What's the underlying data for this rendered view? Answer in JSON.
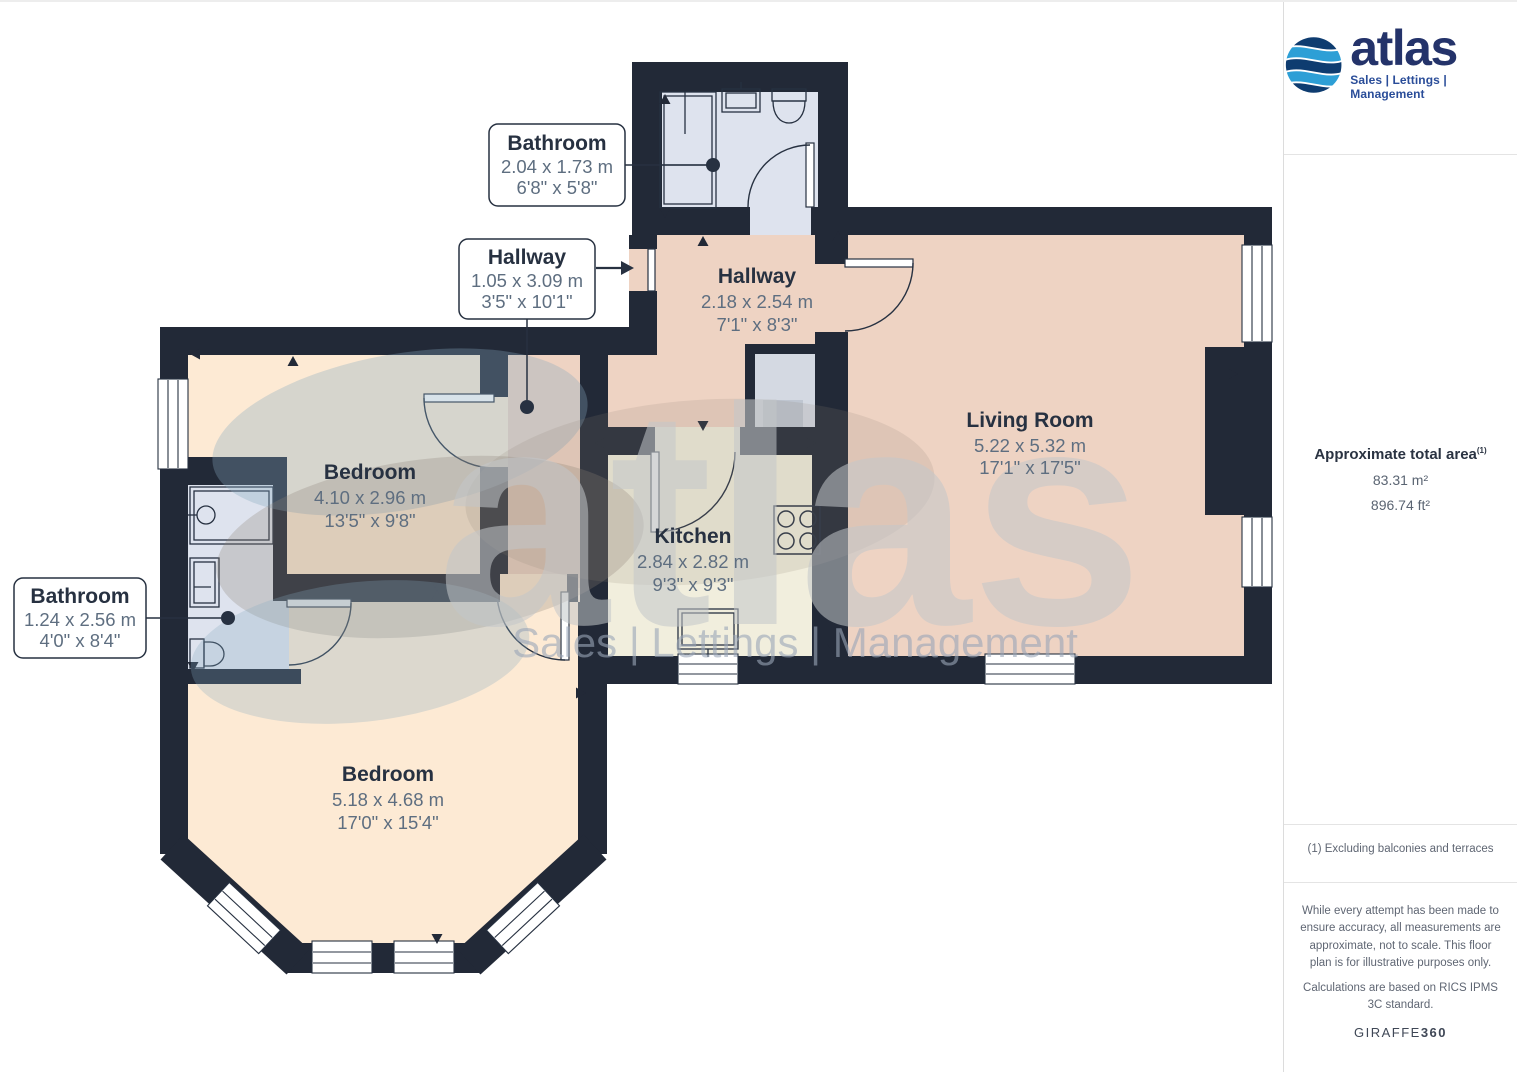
{
  "sidebar": {
    "logo": {
      "brand": "atlas",
      "tagline": "Sales | Lettings | Management"
    },
    "area": {
      "title": "Approximate total area",
      "superscript": "(1)",
      "metric": "83.31 m²",
      "imperial": "896.74 ft²"
    },
    "footnote": "(1) Excluding balconies and terraces",
    "disclaimer": "While every attempt has been made to ensure accuracy, all measurements are approximate, not to scale. This floor plan is for illustrative purposes only.",
    "standard": "Calculations are based on RICS IPMS 3C standard.",
    "giraffe": {
      "normal": "GIRAFFE",
      "bold": "360"
    }
  },
  "floorplan": {
    "watermark": {
      "text": "atlas",
      "tagline": "Sales | Lettings | Management"
    },
    "rooms": [
      {
        "name": "Bathroom",
        "metric": "2.04 x 1.73 m",
        "imperial": "6'8\" x 5'8\""
      },
      {
        "name": "Hallway",
        "metric": "1.05 x 3.09 m",
        "imperial": "3'5\" x 10'1\""
      },
      {
        "name": "Hallway",
        "metric": "2.18 x 2.54 m",
        "imperial": "7'1\" x 8'3\""
      },
      {
        "name": "Living Room",
        "metric": "5.22 x 5.32 m",
        "imperial": "17'1\" x 17'5\""
      },
      {
        "name": "Bedroom",
        "metric": "4.10 x 2.96 m",
        "imperial": "13'5\" x 9'8\""
      },
      {
        "name": "Kitchen",
        "metric": "2.84 x 2.82 m",
        "imperial": "9'3\" x 9'3\""
      },
      {
        "name": "Bathroom",
        "metric": "1.24 x 2.56 m",
        "imperial": "4'0\" x 8'4\""
      },
      {
        "name": "Bedroom",
        "metric": "5.18 x 4.68 m",
        "imperial": "17'0\" x 15'4\""
      }
    ],
    "colors": {
      "wall": "#222937",
      "hallway_living": "#eed3c3",
      "kitchen": "#f1eedd",
      "bedroom": "#fdead4",
      "bathroom": "#dee3ee",
      "cupboard": "#d4d9e2",
      "label_text": "#273141",
      "dimension_text": "#5e6e80",
      "brand_navy": "#24336a",
      "brand_blue": "#2d9fd6",
      "tagline_blue": "#2a4d99"
    }
  }
}
